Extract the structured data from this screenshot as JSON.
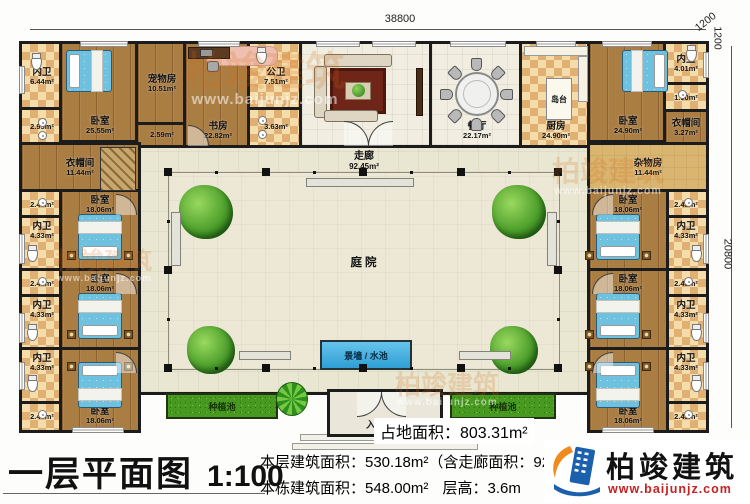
{
  "title_block": {
    "title": "一层平面图",
    "scale": "1:100"
  },
  "stats": {
    "land_area": "占地面积：803.31m²",
    "floor_area": "本层建筑面积：530.18m²（含走廊面积：92.45m²）",
    "building_area": "本栋建筑面积：548.00m²",
    "floor_height": "层高：3.6m"
  },
  "brand": {
    "name": "柏竣建筑",
    "site": "www.baijunjz.com"
  },
  "dimensions": {
    "top_width": "38800",
    "right_height": "20800",
    "offset_top": "1200",
    "offset_right": "1200"
  },
  "zones": {
    "corridor": {
      "label": "走廊",
      "area": "92.45m²"
    },
    "courtyard": {
      "label": "庭院"
    },
    "water": {
      "label": "景墙 / 水池"
    },
    "porch": {
      "label": "入户门廊"
    },
    "planter_left": {
      "label": "种植池"
    },
    "planter_right": {
      "label": "种植池"
    },
    "island": {
      "label": "岛台"
    }
  },
  "rooms": [
    {
      "id": "bath-tl",
      "name": "内卫",
      "area": "6.44m²",
      "x": 22,
      "y": 44,
      "w": 40,
      "h": 66,
      "f": "checker"
    },
    {
      "id": "store-295",
      "name": "",
      "area": "2.95m²",
      "x": 22,
      "y": 110,
      "w": 40,
      "h": 35,
      "f": "checker"
    },
    {
      "id": "bedroom-tl",
      "name": "卧室",
      "area": "25.55m²",
      "x": 62,
      "y": 44,
      "w": 76,
      "h": 96,
      "f": "wood",
      "lp": "s"
    },
    {
      "id": "pet-room",
      "name": "宠物房",
      "area": "10.51m²",
      "x": 138,
      "y": 44,
      "w": 48,
      "h": 81,
      "f": "wood"
    },
    {
      "id": "hall-259",
      "name": "",
      "area": "2.59m²",
      "x": 138,
      "y": 125,
      "w": 48,
      "h": 20,
      "f": "wood"
    },
    {
      "id": "study",
      "name": "书房",
      "area": "22.82m²",
      "x": 186,
      "y": 44,
      "w": 64,
      "h": 101,
      "f": "wood",
      "lp": "s"
    },
    {
      "id": "bath-public",
      "name": "公卫",
      "area": "7.51m²",
      "x": 250,
      "y": 44,
      "w": 52,
      "h": 66,
      "f": "checker"
    },
    {
      "id": "store-363",
      "name": "",
      "area": "3.63m²",
      "x": 250,
      "y": 110,
      "w": 52,
      "h": 35,
      "f": "checker"
    },
    {
      "id": "living",
      "name": "客厅",
      "area": "36.91m²",
      "x": 302,
      "y": 44,
      "w": 130,
      "h": 101,
      "f": "tile"
    },
    {
      "id": "dining",
      "name": "餐厅",
      "area": "22.17m²",
      "x": 432,
      "y": 44,
      "w": 90,
      "h": 101,
      "f": "tile",
      "lp": "s"
    },
    {
      "id": "kitchen",
      "name": "厨房",
      "area": "24.90m²",
      "x": 522,
      "y": 44,
      "w": 68,
      "h": 101,
      "f": "checker",
      "lp": "s"
    },
    {
      "id": "bedroom-tr",
      "name": "卧室",
      "area": "24.90m²",
      "x": 590,
      "y": 44,
      "w": 76,
      "h": 96,
      "f": "wood",
      "lp": "s"
    },
    {
      "id": "bath-tr",
      "name": "内卫",
      "area": "4.01m²",
      "x": 666,
      "y": 44,
      "w": 40,
      "h": 41,
      "f": "checker"
    },
    {
      "id": "store-190",
      "name": "",
      "area": "1.90m²",
      "x": 666,
      "y": 85,
      "w": 40,
      "h": 27,
      "f": "checker"
    },
    {
      "id": "cloak-tr",
      "name": "衣帽间",
      "area": "3.27m²",
      "x": 666,
      "y": 112,
      "w": 40,
      "h": 33,
      "f": "wood"
    },
    {
      "id": "cloak-left",
      "name": "衣帽间",
      "area": "11.44m²",
      "x": 22,
      "y": 145,
      "w": 116,
      "h": 47,
      "f": "wood"
    },
    {
      "id": "utility-right",
      "name": "杂物房",
      "area": "11.44m²",
      "x": 590,
      "y": 145,
      "w": 116,
      "h": 47,
      "f": "plain"
    },
    {
      "id": "closet-a",
      "name": "",
      "area": "2.43m²",
      "x": 22,
      "y": 192,
      "w": 40,
      "h": 26,
      "f": "checker"
    },
    {
      "id": "bath-a",
      "name": "内卫",
      "area": "4.33m²",
      "x": 22,
      "y": 218,
      "w": 40,
      "h": 53,
      "f": "checker",
      "lp": "n"
    },
    {
      "id": "bedroom-a",
      "name": "卧室",
      "area": "18.06m²",
      "x": 62,
      "y": 192,
      "w": 76,
      "h": 79,
      "f": "wood",
      "lp": "n"
    },
    {
      "id": "closet-b",
      "name": "",
      "area": "2.43m²",
      "x": 22,
      "y": 271,
      "w": 40,
      "h": 26,
      "f": "checker"
    },
    {
      "id": "bath-b",
      "name": "内卫",
      "area": "4.33m²",
      "x": 22,
      "y": 297,
      "w": 40,
      "h": 53,
      "f": "checker",
      "lp": "n"
    },
    {
      "id": "bedroom-b",
      "name": "卧室",
      "area": "18.06m²",
      "x": 62,
      "y": 271,
      "w": 76,
      "h": 79,
      "f": "wood",
      "lp": "n"
    },
    {
      "id": "bath-c",
      "name": "内卫",
      "area": "4.33m²",
      "x": 22,
      "y": 350,
      "w": 40,
      "h": 54,
      "f": "checker",
      "lp": "n"
    },
    {
      "id": "closet-c",
      "name": "",
      "area": "2.43m²",
      "x": 22,
      "y": 404,
      "w": 40,
      "h": 26,
      "f": "checker"
    },
    {
      "id": "bedroom-c",
      "name": "卧室",
      "area": "18.06m²",
      "x": 62,
      "y": 350,
      "w": 76,
      "h": 80,
      "f": "wood",
      "lp": "s"
    },
    {
      "id": "closet-d",
      "name": "",
      "area": "2.43m²",
      "x": 666,
      "y": 192,
      "w": 40,
      "h": 26,
      "f": "checker"
    },
    {
      "id": "bath-d",
      "name": "内卫",
      "area": "4.33m²",
      "x": 666,
      "y": 218,
      "w": 40,
      "h": 53,
      "f": "checker",
      "lp": "n"
    },
    {
      "id": "bedroom-d",
      "name": "卧室",
      "area": "18.06m²",
      "x": 590,
      "y": 192,
      "w": 76,
      "h": 79,
      "f": "wood",
      "lp": "n"
    },
    {
      "id": "closet-e",
      "name": "",
      "area": "2.43m²",
      "x": 666,
      "y": 271,
      "w": 40,
      "h": 26,
      "f": "checker"
    },
    {
      "id": "bath-e",
      "name": "内卫",
      "area": "4.33m²",
      "x": 666,
      "y": 297,
      "w": 40,
      "h": 53,
      "f": "checker",
      "lp": "n"
    },
    {
      "id": "bedroom-e",
      "name": "卧室",
      "area": "18.06m²",
      "x": 590,
      "y": 271,
      "w": 76,
      "h": 79,
      "f": "wood",
      "lp": "n"
    },
    {
      "id": "bath-f",
      "name": "内卫",
      "area": "4.33m²",
      "x": 666,
      "y": 350,
      "w": 40,
      "h": 54,
      "f": "checker",
      "lp": "n"
    },
    {
      "id": "closet-f",
      "name": "",
      "area": "2.43m²",
      "x": 666,
      "y": 404,
      "w": 40,
      "h": 26,
      "f": "checker"
    },
    {
      "id": "bedroom-f",
      "name": "卧室",
      "area": "18.06m²",
      "x": 590,
      "y": 350,
      "w": 76,
      "h": 80,
      "f": "wood",
      "lp": "s"
    }
  ],
  "furniture": {
    "beds": [
      {
        "x": 66,
        "y": 50,
        "w": 46,
        "h": 42,
        "head": "left"
      },
      {
        "x": 622,
        "y": 50,
        "w": 46,
        "h": 42,
        "head": "right"
      },
      {
        "x": 78,
        "y": 214,
        "w": 44,
        "h": 46,
        "head": "bottom"
      },
      {
        "x": 78,
        "y": 293,
        "w": 44,
        "h": 46,
        "head": "bottom"
      },
      {
        "x": 78,
        "y": 362,
        "w": 44,
        "h": 46,
        "head": "top"
      },
      {
        "x": 596,
        "y": 214,
        "w": 44,
        "h": 46,
        "head": "bottom"
      },
      {
        "x": 596,
        "y": 293,
        "w": 44,
        "h": 46,
        "head": "bottom"
      },
      {
        "x": 596,
        "y": 362,
        "w": 44,
        "h": 46,
        "head": "top"
      }
    ],
    "trees": [
      {
        "x": 206,
        "y": 212,
        "r": 27
      },
      {
        "x": 519,
        "y": 212,
        "r": 27
      },
      {
        "x": 211,
        "y": 350,
        "r": 24
      },
      {
        "x": 514,
        "y": 350,
        "r": 24
      }
    ],
    "palms": [
      {
        "x": 276,
        "y": 382,
        "w": 32,
        "h": 34
      }
    ],
    "benches": [
      [
        306,
        178,
        108,
        9
      ],
      [
        171,
        212,
        10,
        54
      ],
      [
        547,
        212,
        10,
        54
      ],
      [
        239,
        351,
        52,
        9
      ],
      [
        459,
        351,
        52,
        9
      ]
    ],
    "toilets": [
      [
        31,
        56
      ],
      [
        256,
        50
      ],
      [
        686,
        48
      ],
      [
        27,
        248
      ],
      [
        27,
        327
      ],
      [
        27,
        378
      ],
      [
        691,
        248
      ],
      [
        691,
        327
      ],
      [
        691,
        378
      ]
    ],
    "sinks": [
      [
        38,
        118
      ],
      [
        38,
        131
      ],
      [
        258,
        116
      ],
      [
        258,
        130
      ],
      [
        678,
        90
      ],
      [
        38,
        198
      ],
      [
        38,
        277
      ],
      [
        38,
        410
      ],
      [
        684,
        198
      ],
      [
        684,
        277
      ],
      [
        684,
        410
      ]
    ]
  },
  "windows": [
    [
      80,
      41,
      48,
      6
    ],
    [
      198,
      41,
      42,
      6
    ],
    [
      316,
      41,
      44,
      6
    ],
    [
      372,
      41,
      44,
      6
    ],
    [
      450,
      41,
      56,
      6
    ],
    [
      536,
      41,
      40,
      6
    ],
    [
      602,
      41,
      50,
      6
    ],
    [
      72,
      427,
      52,
      6
    ],
    [
      602,
      427,
      52,
      6
    ],
    [
      19,
      66,
      6,
      28
    ],
    [
      19,
      234,
      6,
      30
    ],
    [
      19,
      313,
      6,
      30
    ],
    [
      19,
      362,
      6,
      28
    ],
    [
      703,
      52,
      6,
      26
    ],
    [
      703,
      234,
      6,
      30
    ],
    [
      703,
      313,
      6,
      30
    ],
    [
      703,
      362,
      6,
      28
    ]
  ],
  "doors": [
    [
      344,
      121,
      24,
      "tr"
    ],
    [
      368,
      121,
      24,
      "tl"
    ],
    [
      357,
      392,
      24,
      "br"
    ],
    [
      381,
      392,
      24,
      "bl"
    ],
    [
      188,
      125,
      20,
      "tr"
    ],
    [
      116,
      194,
      20,
      "tr"
    ],
    [
      116,
      273,
      20,
      "tr"
    ],
    [
      116,
      352,
      20,
      "tr"
    ],
    [
      592,
      194,
      20,
      "tl"
    ],
    [
      592,
      273,
      20,
      "tl"
    ],
    [
      592,
      352,
      20,
      "tl"
    ]
  ]
}
